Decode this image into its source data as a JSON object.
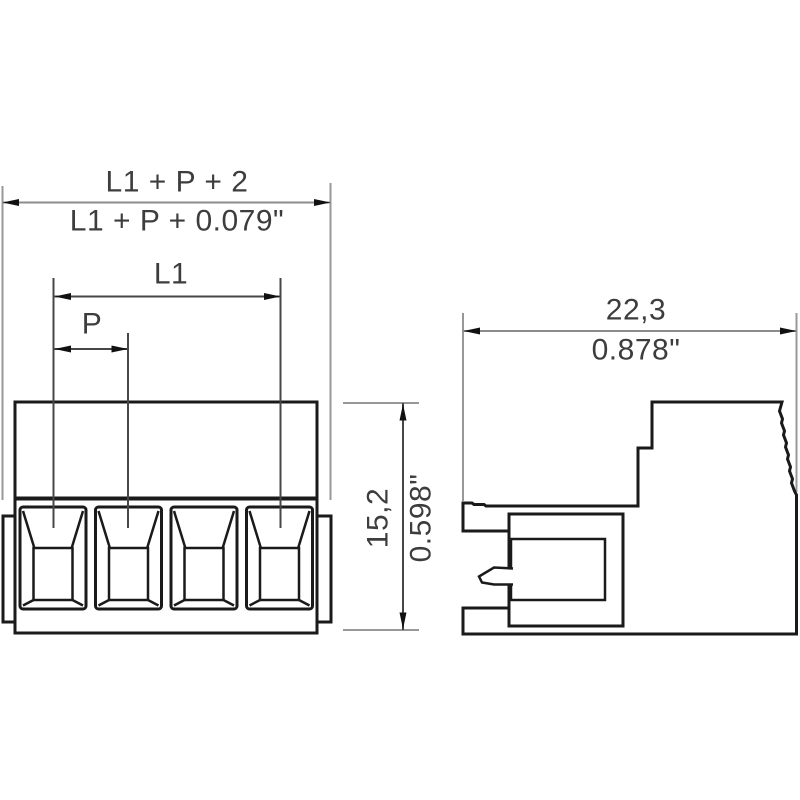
{
  "drawing": {
    "front_view": {
      "overall_width_mm_label": "L1 + P + 2",
      "overall_width_inch_label": "L1 + P + 0.079\"",
      "l1_label": "L1",
      "pitch_label": "P",
      "height_mm_label": "15,2",
      "height_inch_label": "0.598\"",
      "pole_count": 4
    },
    "side_view": {
      "depth_mm_label": "22,3",
      "depth_inch_label": "0.878\""
    },
    "colors": {
      "outline": "#1a1a1a",
      "dimension": "#474747",
      "dimension_light": "#8c8c8c",
      "extension": "#989898",
      "arrow": "#111111",
      "text": "#3d3d3d",
      "background": "#ffffff"
    }
  }
}
